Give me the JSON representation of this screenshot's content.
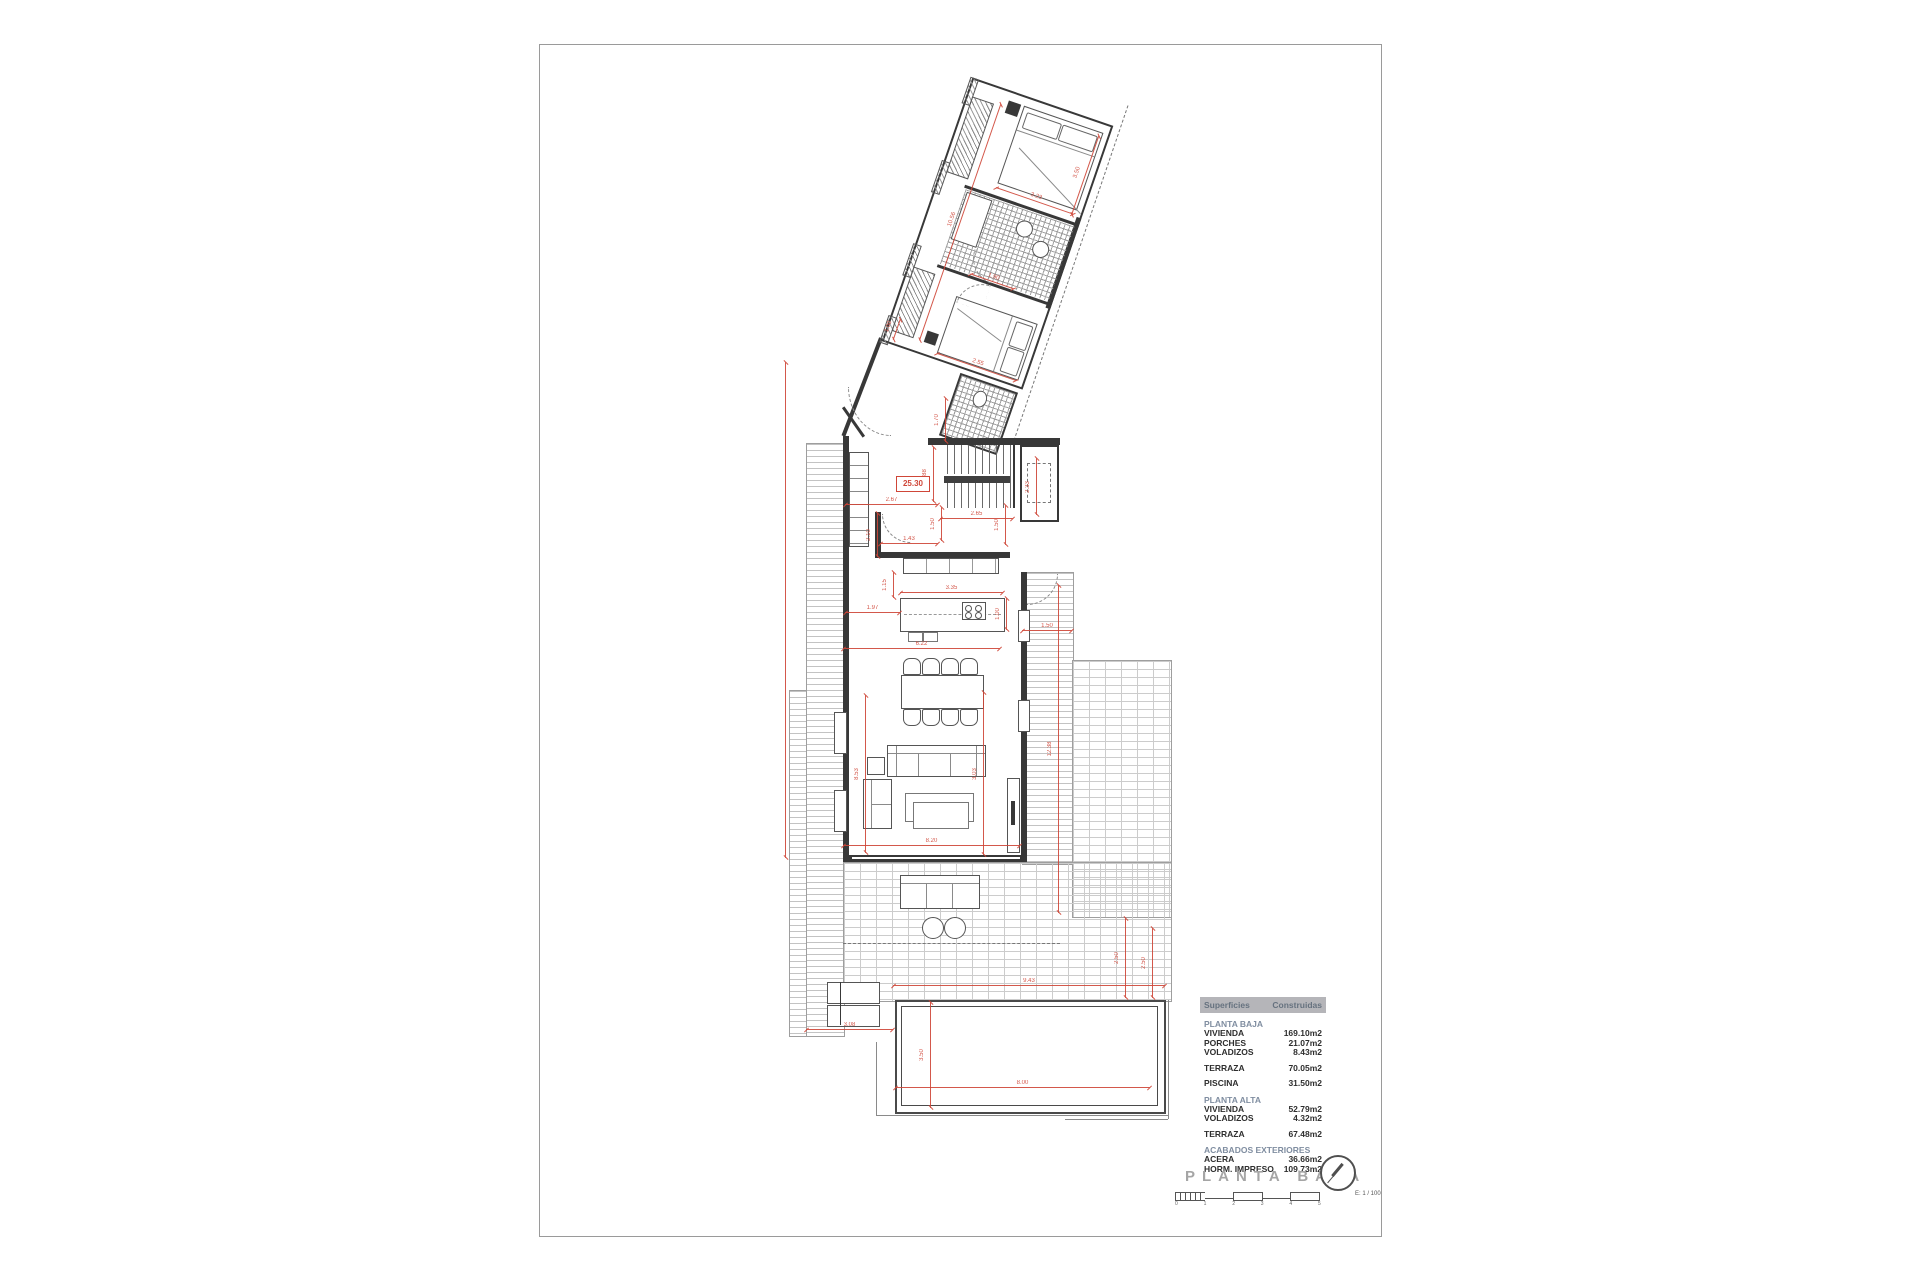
{
  "sheet": {
    "name": "drawing-sheet"
  },
  "plan": {
    "total_length_label": "25.30",
    "dimensions": [
      {
        "t": "2.67",
        "x": 845,
        "y": 504,
        "len": 93,
        "o": "h"
      },
      {
        "t": "2.88",
        "x": 933,
        "y": 447,
        "len": 55,
        "o": "v"
      },
      {
        "t": "1.43",
        "x": 880,
        "y": 543,
        "len": 58,
        "o": "h"
      },
      {
        "t": "2.65",
        "x": 940,
        "y": 518,
        "len": 73,
        "o": "h"
      },
      {
        "t": "1.50",
        "x": 941,
        "y": 507,
        "len": 34,
        "o": "v"
      },
      {
        "t": "1.50",
        "x": 1005,
        "y": 505,
        "len": 40,
        "o": "v"
      },
      {
        "t": "2.10",
        "x": 877,
        "y": 513,
        "len": 44,
        "o": "v"
      },
      {
        "t": "3.35",
        "x": 900,
        "y": 592,
        "len": 103,
        "o": "h"
      },
      {
        "t": "1.15",
        "x": 893,
        "y": 572,
        "len": 26,
        "o": "v"
      },
      {
        "t": "1.97",
        "x": 845,
        "y": 612,
        "len": 55,
        "o": "h"
      },
      {
        "t": "1.00",
        "x": 1006,
        "y": 598,
        "len": 32,
        "o": "v"
      },
      {
        "t": "6.22",
        "x": 843,
        "y": 648,
        "len": 157,
        "o": "h"
      },
      {
        "t": "8.20",
        "x": 843,
        "y": 845,
        "len": 177,
        "o": "h"
      },
      {
        "t": "8.53",
        "x": 865,
        "y": 695,
        "len": 158,
        "o": "v"
      },
      {
        "t": "3.03",
        "x": 983,
        "y": 692,
        "len": 163,
        "o": "v"
      },
      {
        "t": "12.38",
        "x": 1058,
        "y": 585,
        "len": 328,
        "o": "v"
      },
      {
        "t": "1.50",
        "x": 1022,
        "y": 630,
        "len": 50,
        "o": "h"
      },
      {
        "t": "2.50",
        "x": 1125,
        "y": 918,
        "len": 80,
        "o": "v"
      },
      {
        "t": "9.43",
        "x": 893,
        "y": 985,
        "len": 272,
        "o": "h"
      },
      {
        "t": "3.08",
        "x": 806,
        "y": 1029,
        "len": 87,
        "o": "h"
      },
      {
        "t": "3.50",
        "x": 930,
        "y": 1002,
        "len": 106,
        "o": "v"
      },
      {
        "t": "8.00",
        "x": 895,
        "y": 1087,
        "len": 255,
        "o": "h"
      },
      {
        "t": "2.33",
        "x": 1036,
        "y": 458,
        "len": 57,
        "o": "v"
      },
      {
        "t": "1.70",
        "x": 945,
        "y": 398,
        "len": 44,
        "o": "v"
      },
      {
        "t": "2.50",
        "x": 1152,
        "y": 928,
        "len": 70,
        "o": "v"
      },
      {
        "t": "",
        "x": 785,
        "y": 362,
        "len": 496,
        "o": "v"
      }
    ],
    "wing_dimensions": [
      {
        "t": "3.23",
        "x": 56,
        "y": 94,
        "len": 82,
        "o": "h"
      },
      {
        "t": "1.90",
        "x": 60,
        "y": 184,
        "len": 46,
        "o": "h"
      },
      {
        "t": "3.50",
        "x": 136,
        "y": 12,
        "len": 84,
        "o": "v"
      },
      {
        "t": "2.55",
        "x": 54,
        "y": 270,
        "len": 84,
        "o": "h"
      },
      {
        "t": "10.56",
        "x": 33,
        "y": 14,
        "len": 250,
        "o": "v"
      },
      {
        "t": "1.00",
        "x": 8,
        "y": 250,
        "len": 22,
        "o": "v"
      }
    ]
  },
  "summary_table": {
    "header": {
      "col1": "Superficies",
      "col2": "Construidas"
    },
    "sections": [
      {
        "header": "PLANTA BAJA",
        "rows": [
          {
            "label": "VIVIENDA",
            "value": "169.10m2"
          },
          {
            "label": "PORCHES",
            "value": "21.07m2"
          },
          {
            "label": "VOLADIZOS",
            "value": "8.43m2"
          }
        ]
      },
      {
        "header": null,
        "rows": [
          {
            "label": "TERRAZA",
            "value": "70.05m2"
          }
        ]
      },
      {
        "header": null,
        "rows": [
          {
            "label": "PISCINA",
            "value": "31.50m2"
          }
        ]
      },
      {
        "header": "PLANTA ALTA",
        "rows": [
          {
            "label": "VIVIENDA",
            "value": "52.79m2"
          },
          {
            "label": "VOLADIZOS",
            "value": "4.32m2"
          }
        ]
      },
      {
        "header": null,
        "rows": [
          {
            "label": "TERRAZA",
            "value": "67.48m2"
          }
        ]
      },
      {
        "header": "ACABADOS EXTERIORES",
        "rows": [
          {
            "label": "ACERA",
            "value": "36.66m2"
          },
          {
            "label": "HORM. IMPRESO",
            "value": "109.73m2"
          }
        ]
      }
    ]
  },
  "title_block": {
    "title": "PLANTA BAJA",
    "scale_text": "E: 1 / 100",
    "scale_numbers": [
      "0",
      "1",
      "2",
      "3",
      "4",
      "5"
    ],
    "north_icon": "north-arrow-icon"
  }
}
